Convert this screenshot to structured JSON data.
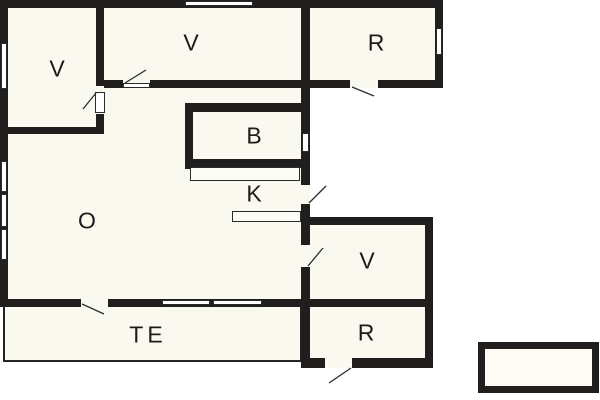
{
  "canvas": {
    "width": 600,
    "height": 400,
    "background": "#ffffff"
  },
  "colors": {
    "wall": "#211e1e",
    "floor": "#faf9f0",
    "window_fill": "#ffffff",
    "swing_line": "#2e2e2e",
    "label_text": "#1c1a1a"
  },
  "rooms": [
    {
      "id": "v-top-left",
      "label": "V",
      "cx": 57,
      "cy": 69
    },
    {
      "id": "v-top-middle",
      "label": "V",
      "cx": 191,
      "cy": 43
    },
    {
      "id": "r-top-right",
      "label": "R",
      "cx": 376,
      "cy": 43
    },
    {
      "id": "b-bath",
      "label": "B",
      "cx": 254,
      "cy": 136
    },
    {
      "id": "k-kitchen",
      "label": "K",
      "cx": 254,
      "cy": 194
    },
    {
      "id": "o-living",
      "label": "O",
      "cx": 87,
      "cy": 221
    },
    {
      "id": "v-bottom-right",
      "label": "V",
      "cx": 367,
      "cy": 261
    },
    {
      "id": "r-bottom-right",
      "label": "R",
      "cx": 366,
      "cy": 333
    },
    {
      "id": "te-terrace",
      "label": "TE",
      "cx": 148,
      "cy": 335
    }
  ],
  "floors": [
    {
      "id": "main-house",
      "x": 0,
      "y": 0,
      "w": 310,
      "h": 307
    },
    {
      "id": "annex-top-right",
      "x": 300,
      "y": 0,
      "w": 143,
      "h": 88
    },
    {
      "id": "annex-bottom-right",
      "x": 300,
      "y": 217,
      "w": 133,
      "h": 151
    }
  ],
  "terrace": {
    "id": "terrace-outline",
    "x": 3,
    "y": 303,
    "w": 299,
    "h": 59
  },
  "outbuilding": {
    "id": "outbuilding",
    "x": 478,
    "y": 342,
    "w": 121,
    "h": 51
  },
  "walls": [
    {
      "id": "top-exterior",
      "x": 0,
      "y": 0,
      "w": 443,
      "h": 8
    },
    {
      "id": "left-exterior",
      "x": 0,
      "y": 0,
      "w": 8,
      "h": 307
    },
    {
      "id": "living-bottom",
      "x": 0,
      "y": 299,
      "w": 311,
      "h": 8
    },
    {
      "id": "vestibule-right",
      "x": 96,
      "y": 0,
      "w": 8,
      "h": 134
    },
    {
      "id": "vestibule-bottom",
      "x": 0,
      "y": 127,
      "w": 104,
      "h": 7
    },
    {
      "id": "mid-horizontal",
      "x": 96,
      "y": 80,
      "w": 347,
      "h": 8
    },
    {
      "id": "main-right-vertical",
      "x": 301,
      "y": 0,
      "w": 9,
      "h": 368
    },
    {
      "id": "annex-tr-right",
      "x": 435,
      "y": 0,
      "w": 8,
      "h": 88
    },
    {
      "id": "annex-br-top",
      "x": 301,
      "y": 217,
      "w": 132,
      "h": 8
    },
    {
      "id": "annex-br-right",
      "x": 425,
      "y": 217,
      "w": 8,
      "h": 151
    },
    {
      "id": "annex-br-divider",
      "x": 301,
      "y": 299,
      "w": 132,
      "h": 8
    },
    {
      "id": "annex-br-bottom",
      "x": 301,
      "y": 358,
      "w": 132,
      "h": 10
    },
    {
      "id": "bath-left",
      "x": 185,
      "y": 103,
      "w": 8,
      "h": 66
    },
    {
      "id": "bath-top",
      "x": 185,
      "y": 103,
      "w": 125,
      "h": 9
    },
    {
      "id": "bath-bottom",
      "x": 185,
      "y": 159,
      "w": 116,
      "h": 9
    }
  ],
  "door_gaps": [
    {
      "id": "door-vestibule",
      "x": 96,
      "y": 86,
      "w": 8,
      "h": 28
    },
    {
      "id": "door-v-top",
      "x": 123,
      "y": 80,
      "w": 27,
      "h": 8
    },
    {
      "id": "door-r-top",
      "x": 350,
      "y": 80,
      "w": 28,
      "h": 8
    },
    {
      "id": "door-terrace",
      "x": 81,
      "y": 299,
      "w": 27,
      "h": 8
    },
    {
      "id": "door-entry-right",
      "x": 301,
      "y": 185,
      "w": 9,
      "h": 19
    },
    {
      "id": "door-v-bottom",
      "x": 301,
      "y": 245,
      "w": 9,
      "h": 22
    },
    {
      "id": "door-r-bottom",
      "x": 325,
      "y": 358,
      "w": 27,
      "h": 10
    }
  ],
  "door_leaves": [
    {
      "id": "leaf-vestibule",
      "x": 95,
      "y": 92,
      "w": 10,
      "h": 21
    },
    {
      "id": "leaf-v-top",
      "x": 123,
      "y": 83,
      "w": 27,
      "h": 5
    }
  ],
  "windows": [
    {
      "id": "window-top",
      "x": 185,
      "y": 1,
      "w": 68,
      "h": 5
    },
    {
      "id": "window-left-upper",
      "x": 1,
      "y": 43,
      "w": 6,
      "h": 46
    },
    {
      "id": "window-left-mid-1",
      "x": 1,
      "y": 161,
      "w": 6,
      "h": 31
    },
    {
      "id": "window-left-mid-2",
      "x": 1,
      "y": 194,
      "w": 6,
      "h": 33
    },
    {
      "id": "window-left-mid-3",
      "x": 1,
      "y": 229,
      "w": 6,
      "h": 31
    },
    {
      "id": "window-annex-tr",
      "x": 436,
      "y": 28,
      "w": 6,
      "h": 27
    },
    {
      "id": "window-mid-right",
      "x": 302,
      "y": 133,
      "w": 7,
      "h": 19
    },
    {
      "id": "window-terrace-1",
      "x": 162,
      "y": 300,
      "w": 48,
      "h": 5
    },
    {
      "id": "window-terrace-2",
      "x": 213,
      "y": 300,
      "w": 49,
      "h": 5
    }
  ],
  "counters": [
    {
      "id": "counter-bath",
      "x": 190,
      "y": 167,
      "w": 110,
      "h": 14
    },
    {
      "id": "counter-kitchen",
      "x": 232,
      "y": 211,
      "w": 69,
      "h": 11
    }
  ],
  "swing_lines": [
    {
      "id": "swing-vestibule",
      "x1": 96,
      "y1": 93,
      "x2": 83,
      "y2": 109
    },
    {
      "id": "swing-v-top",
      "x1": 125,
      "y1": 83,
      "x2": 146,
      "y2": 70
    },
    {
      "id": "swing-r-top",
      "x1": 352,
      "y1": 87,
      "x2": 374,
      "y2": 96
    },
    {
      "id": "swing-terrace",
      "x1": 82,
      "y1": 304,
      "x2": 104,
      "y2": 314
    },
    {
      "id": "swing-entry-right",
      "x1": 309,
      "y1": 203,
      "x2": 326,
      "y2": 186
    },
    {
      "id": "swing-v-bottom",
      "x1": 308,
      "y1": 266,
      "x2": 323,
      "y2": 248
    },
    {
      "id": "swing-r-bottom",
      "x1": 351,
      "y1": 368,
      "x2": 329,
      "y2": 383
    }
  ]
}
